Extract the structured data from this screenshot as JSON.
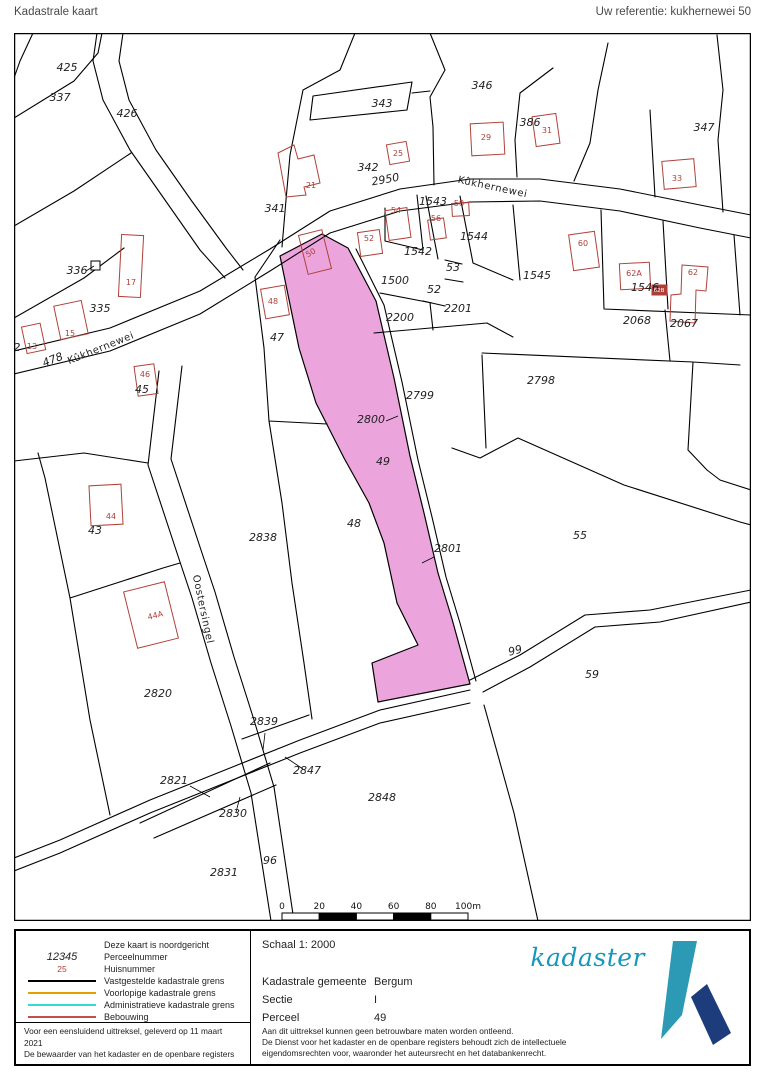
{
  "header": {
    "title": "Kadastrale kaart",
    "reference": "Uw referentie: kukhernewei 50"
  },
  "colors": {
    "selected_parcel_fill": "#eca5dc",
    "building_red": "#ae3f38",
    "vastgesteld": "#000000",
    "voorlopig": "#dfa000",
    "administratief": "#35d9cf",
    "bebouwing": "#c0504d",
    "logo_teal": "#1796bc",
    "logo_darkblue": "#1d3c7c"
  },
  "map": {
    "parcel_labels": [
      {
        "t": "425",
        "x": 53,
        "y": 38
      },
      {
        "t": "337",
        "x": 46,
        "y": 68
      },
      {
        "t": "426",
        "x": 113,
        "y": 84
      },
      {
        "t": "343",
        "x": 368,
        "y": 74
      },
      {
        "t": "342",
        "x": 354,
        "y": 138
      },
      {
        "t": "341",
        "x": 261,
        "y": 179
      },
      {
        "t": "346",
        "x": 468,
        "y": 56
      },
      {
        "t": "386",
        "x": 516,
        "y": 93
      },
      {
        "t": "347",
        "x": 690,
        "y": 98
      },
      {
        "t": "2950",
        "x": 372,
        "y": 150,
        "r": -10
      },
      {
        "t": "1543",
        "x": 419,
        "y": 172
      },
      {
        "t": "1542",
        "x": 404,
        "y": 222
      },
      {
        "t": "1544",
        "x": 460,
        "y": 207
      },
      {
        "t": "1545",
        "x": 523,
        "y": 246
      },
      {
        "t": "53",
        "x": 439,
        "y": 238
      },
      {
        "t": "52",
        "x": 420,
        "y": 260
      },
      {
        "t": "1500",
        "x": 381,
        "y": 251
      },
      {
        "t": "2200",
        "x": 386,
        "y": 288
      },
      {
        "t": "2201",
        "x": 444,
        "y": 279
      },
      {
        "t": "1546",
        "x": 631,
        "y": 258
      },
      {
        "t": "2068",
        "x": 623,
        "y": 291
      },
      {
        "t": "2067",
        "x": 670,
        "y": 294
      },
      {
        "t": "2798",
        "x": 527,
        "y": 351
      },
      {
        "t": "2799",
        "x": 406,
        "y": 366
      },
      {
        "t": "336",
        "x": 63,
        "y": 241
      },
      {
        "t": "335",
        "x": 86,
        "y": 279
      },
      {
        "t": "478",
        "x": 40,
        "y": 330,
        "r": -22
      },
      {
        "t": "2",
        "x": 3,
        "y": 318
      },
      {
        "t": "45",
        "x": 128,
        "y": 360
      },
      {
        "t": "47",
        "x": 263,
        "y": 308
      },
      {
        "t": "48",
        "x": 340,
        "y": 494
      },
      {
        "t": "49",
        "x": 369,
        "y": 432
      },
      {
        "t": "2800",
        "x": 357,
        "y": 390
      },
      {
        "t": "2801",
        "x": 434,
        "y": 519
      },
      {
        "t": "55",
        "x": 566,
        "y": 506
      },
      {
        "t": "59",
        "x": 578,
        "y": 645
      },
      {
        "t": "99",
        "x": 502,
        "y": 621,
        "r": -14
      },
      {
        "t": "2838",
        "x": 249,
        "y": 508
      },
      {
        "t": "43",
        "x": 81,
        "y": 501
      },
      {
        "t": "2820",
        "x": 144,
        "y": 664
      },
      {
        "t": "2839",
        "x": 250,
        "y": 692
      },
      {
        "t": "2847",
        "x": 293,
        "y": 741
      },
      {
        "t": "2821",
        "x": 160,
        "y": 751
      },
      {
        "t": "2830",
        "x": 219,
        "y": 784
      },
      {
        "t": "2848",
        "x": 368,
        "y": 768
      },
      {
        "t": "96",
        "x": 256,
        "y": 831
      },
      {
        "t": "2831",
        "x": 210,
        "y": 843
      }
    ],
    "house_numbers": [
      {
        "t": "21",
        "x": 297,
        "y": 155
      },
      {
        "t": "25",
        "x": 384,
        "y": 123
      },
      {
        "t": "29",
        "x": 472,
        "y": 107
      },
      {
        "t": "31",
        "x": 533,
        "y": 100
      },
      {
        "t": "33",
        "x": 663,
        "y": 148
      },
      {
        "t": "17",
        "x": 117,
        "y": 252
      },
      {
        "t": "15",
        "x": 56,
        "y": 303
      },
      {
        "t": "13",
        "x": 18,
        "y": 316
      },
      {
        "t": "46",
        "x": 131,
        "y": 344
      },
      {
        "t": "44",
        "x": 97,
        "y": 486
      },
      {
        "t": "44A",
        "x": 142,
        "y": 585,
        "r": -14
      },
      {
        "t": "50",
        "x": 298,
        "y": 222,
        "r": -30
      },
      {
        "t": "48",
        "x": 259,
        "y": 271
      },
      {
        "t": "52",
        "x": 355,
        "y": 208
      },
      {
        "t": "54",
        "x": 382,
        "y": 180
      },
      {
        "t": "56",
        "x": 422,
        "y": 188
      },
      {
        "t": "58",
        "x": 445,
        "y": 173
      },
      {
        "t": "60",
        "x": 569,
        "y": 213
      },
      {
        "t": "62A",
        "x": 620,
        "y": 243
      },
      {
        "t": "62",
        "x": 679,
        "y": 242
      },
      {
        "t": "62B",
        "x": 645,
        "y": 259,
        "w": 1
      }
    ],
    "road_labels": [
      {
        "t": "Kûkhernewei",
        "x": 478,
        "y": 157,
        "r": 12
      },
      {
        "t": "Kûkhernewei",
        "x": 88,
        "y": 318,
        "r": -22
      },
      {
        "t": "Oostersingel",
        "x": 186,
        "y": 577,
        "r": 78
      }
    ],
    "scale_bar": {
      "ticks": [
        "0",
        "20",
        "40",
        "60",
        "80",
        "100m"
      ]
    }
  },
  "legend": {
    "north_note": "Deze kaart is noordgericht",
    "items": [
      {
        "type": "num",
        "sample": "12345",
        "label": "Perceelnummer"
      },
      {
        "type": "red",
        "sample": "25",
        "label": "Huisnummer"
      },
      {
        "type": "line",
        "color": "#000000",
        "label": "Vastgestelde kadastrale grens"
      },
      {
        "type": "line",
        "color": "#dfa000",
        "label": "Voorlopige kadastrale grens"
      },
      {
        "type": "line",
        "color": "#35d9cf",
        "label": "Administratieve kadastrale grens"
      },
      {
        "type": "line",
        "color": "#c0504d",
        "label": "Bebouwing"
      }
    ],
    "footnote1": "Voor een eensluidend uittreksel, geleverd op 11 maart 2021",
    "footnote2": "De bewaarder van het kadaster en de openbare registers"
  },
  "info": {
    "scale_label": "Schaal 1: 2000",
    "fields": [
      {
        "label": "Kadastrale gemeente",
        "value": "Bergum"
      },
      {
        "label": "Sectie",
        "value": "I"
      },
      {
        "label": "Perceel",
        "value": "49"
      }
    ],
    "disclaimer": [
      "Aan dit uittreksel kunnen geen betrouwbare maten worden ontleend.",
      "De Dienst voor het kadaster en de openbare registers behoudt zich de intellectuele",
      "eigendomsrechten voor, waaronder het auteursrecht en het databankenrecht."
    ]
  },
  "logo": {
    "text": "kadaster"
  }
}
